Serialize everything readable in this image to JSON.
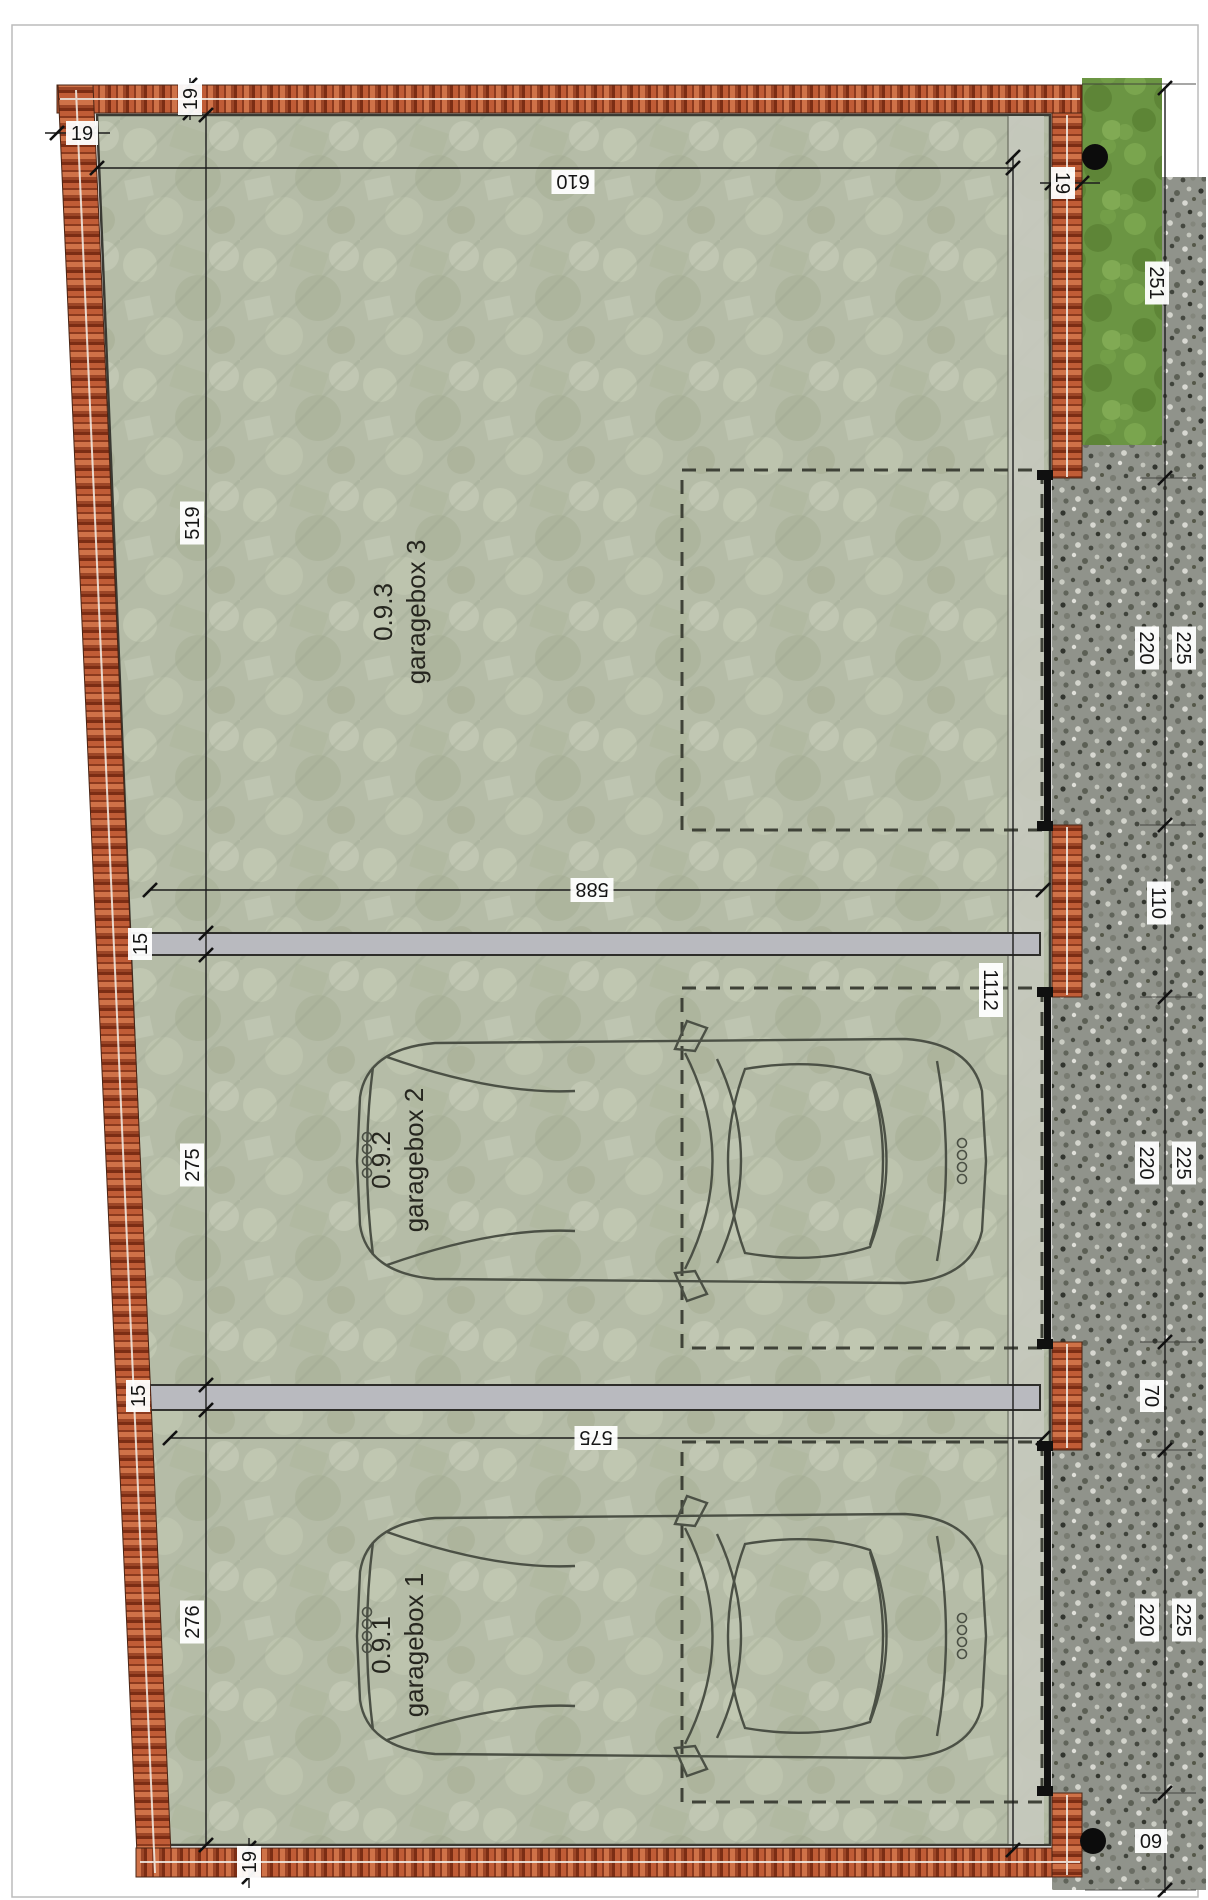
{
  "plan": {
    "garages": [
      {
        "id": "0.9.3",
        "name": "garagebox 3",
        "cx": 408,
        "cy": 612
      },
      {
        "id": "0.9.2",
        "name": "garagebox 2",
        "cx": 406,
        "cy": 1160
      },
      {
        "id": "0.9.1",
        "name": "garagebox 1",
        "cx": 406,
        "cy": 1645
      }
    ],
    "dimension_labels": [
      {
        "text": "610",
        "x": 573,
        "y": 182,
        "rot": 180
      },
      {
        "text": "588",
        "x": 592,
        "y": 890,
        "rot": 180
      },
      {
        "text": "575",
        "x": 596,
        "y": 1438,
        "rot": 180
      },
      {
        "text": "519",
        "x": 192,
        "y": 523,
        "rot": -90
      },
      {
        "text": "275",
        "x": 192,
        "y": 1165,
        "rot": -90
      },
      {
        "text": "276",
        "x": 192,
        "y": 1622,
        "rot": -90
      },
      {
        "text": "15",
        "x": 140,
        "y": 944,
        "rot": -90
      },
      {
        "text": "15",
        "x": 138,
        "y": 1396,
        "rot": -90
      },
      {
        "text": "19",
        "x": 82,
        "y": 133,
        "rot": 0
      },
      {
        "text": "19",
        "x": 190,
        "y": 99,
        "rot": -90
      },
      {
        "text": "19",
        "x": 1063,
        "y": 183,
        "rot": 90
      },
      {
        "text": "19",
        "x": 249,
        "y": 1862,
        "rot": -90
      },
      {
        "text": "251",
        "x": 1157,
        "y": 283,
        "rot": 90
      },
      {
        "text": "220",
        "x": 1147,
        "y": 648,
        "rot": 90
      },
      {
        "text": "225",
        "x": 1184,
        "y": 648,
        "rot": 90
      },
      {
        "text": "110",
        "x": 1159,
        "y": 903,
        "rot": 90
      },
      {
        "text": "220",
        "x": 1147,
        "y": 1163,
        "rot": 90
      },
      {
        "text": "225",
        "x": 1184,
        "y": 1163,
        "rot": 90
      },
      {
        "text": "70",
        "x": 1152,
        "y": 1396,
        "rot": 90
      },
      {
        "text": "220",
        "x": 1147,
        "y": 1620,
        "rot": 90
      },
      {
        "text": "225",
        "x": 1184,
        "y": 1620,
        "rot": 90
      },
      {
        "text": "60",
        "x": 1151,
        "y": 1841,
        "rot": 180
      },
      {
        "text": "1112",
        "x": 991,
        "y": 990,
        "rot": 90
      }
    ],
    "colors": {
      "brick": "#b5502e",
      "brick_dark": "#7c2d14",
      "brick_light": "#cf7248",
      "floor": "#b5bca7",
      "divider": "#b9babf",
      "grass": "#6b9543",
      "gravel": "#90938b",
      "line": "#1c1c1c"
    }
  }
}
